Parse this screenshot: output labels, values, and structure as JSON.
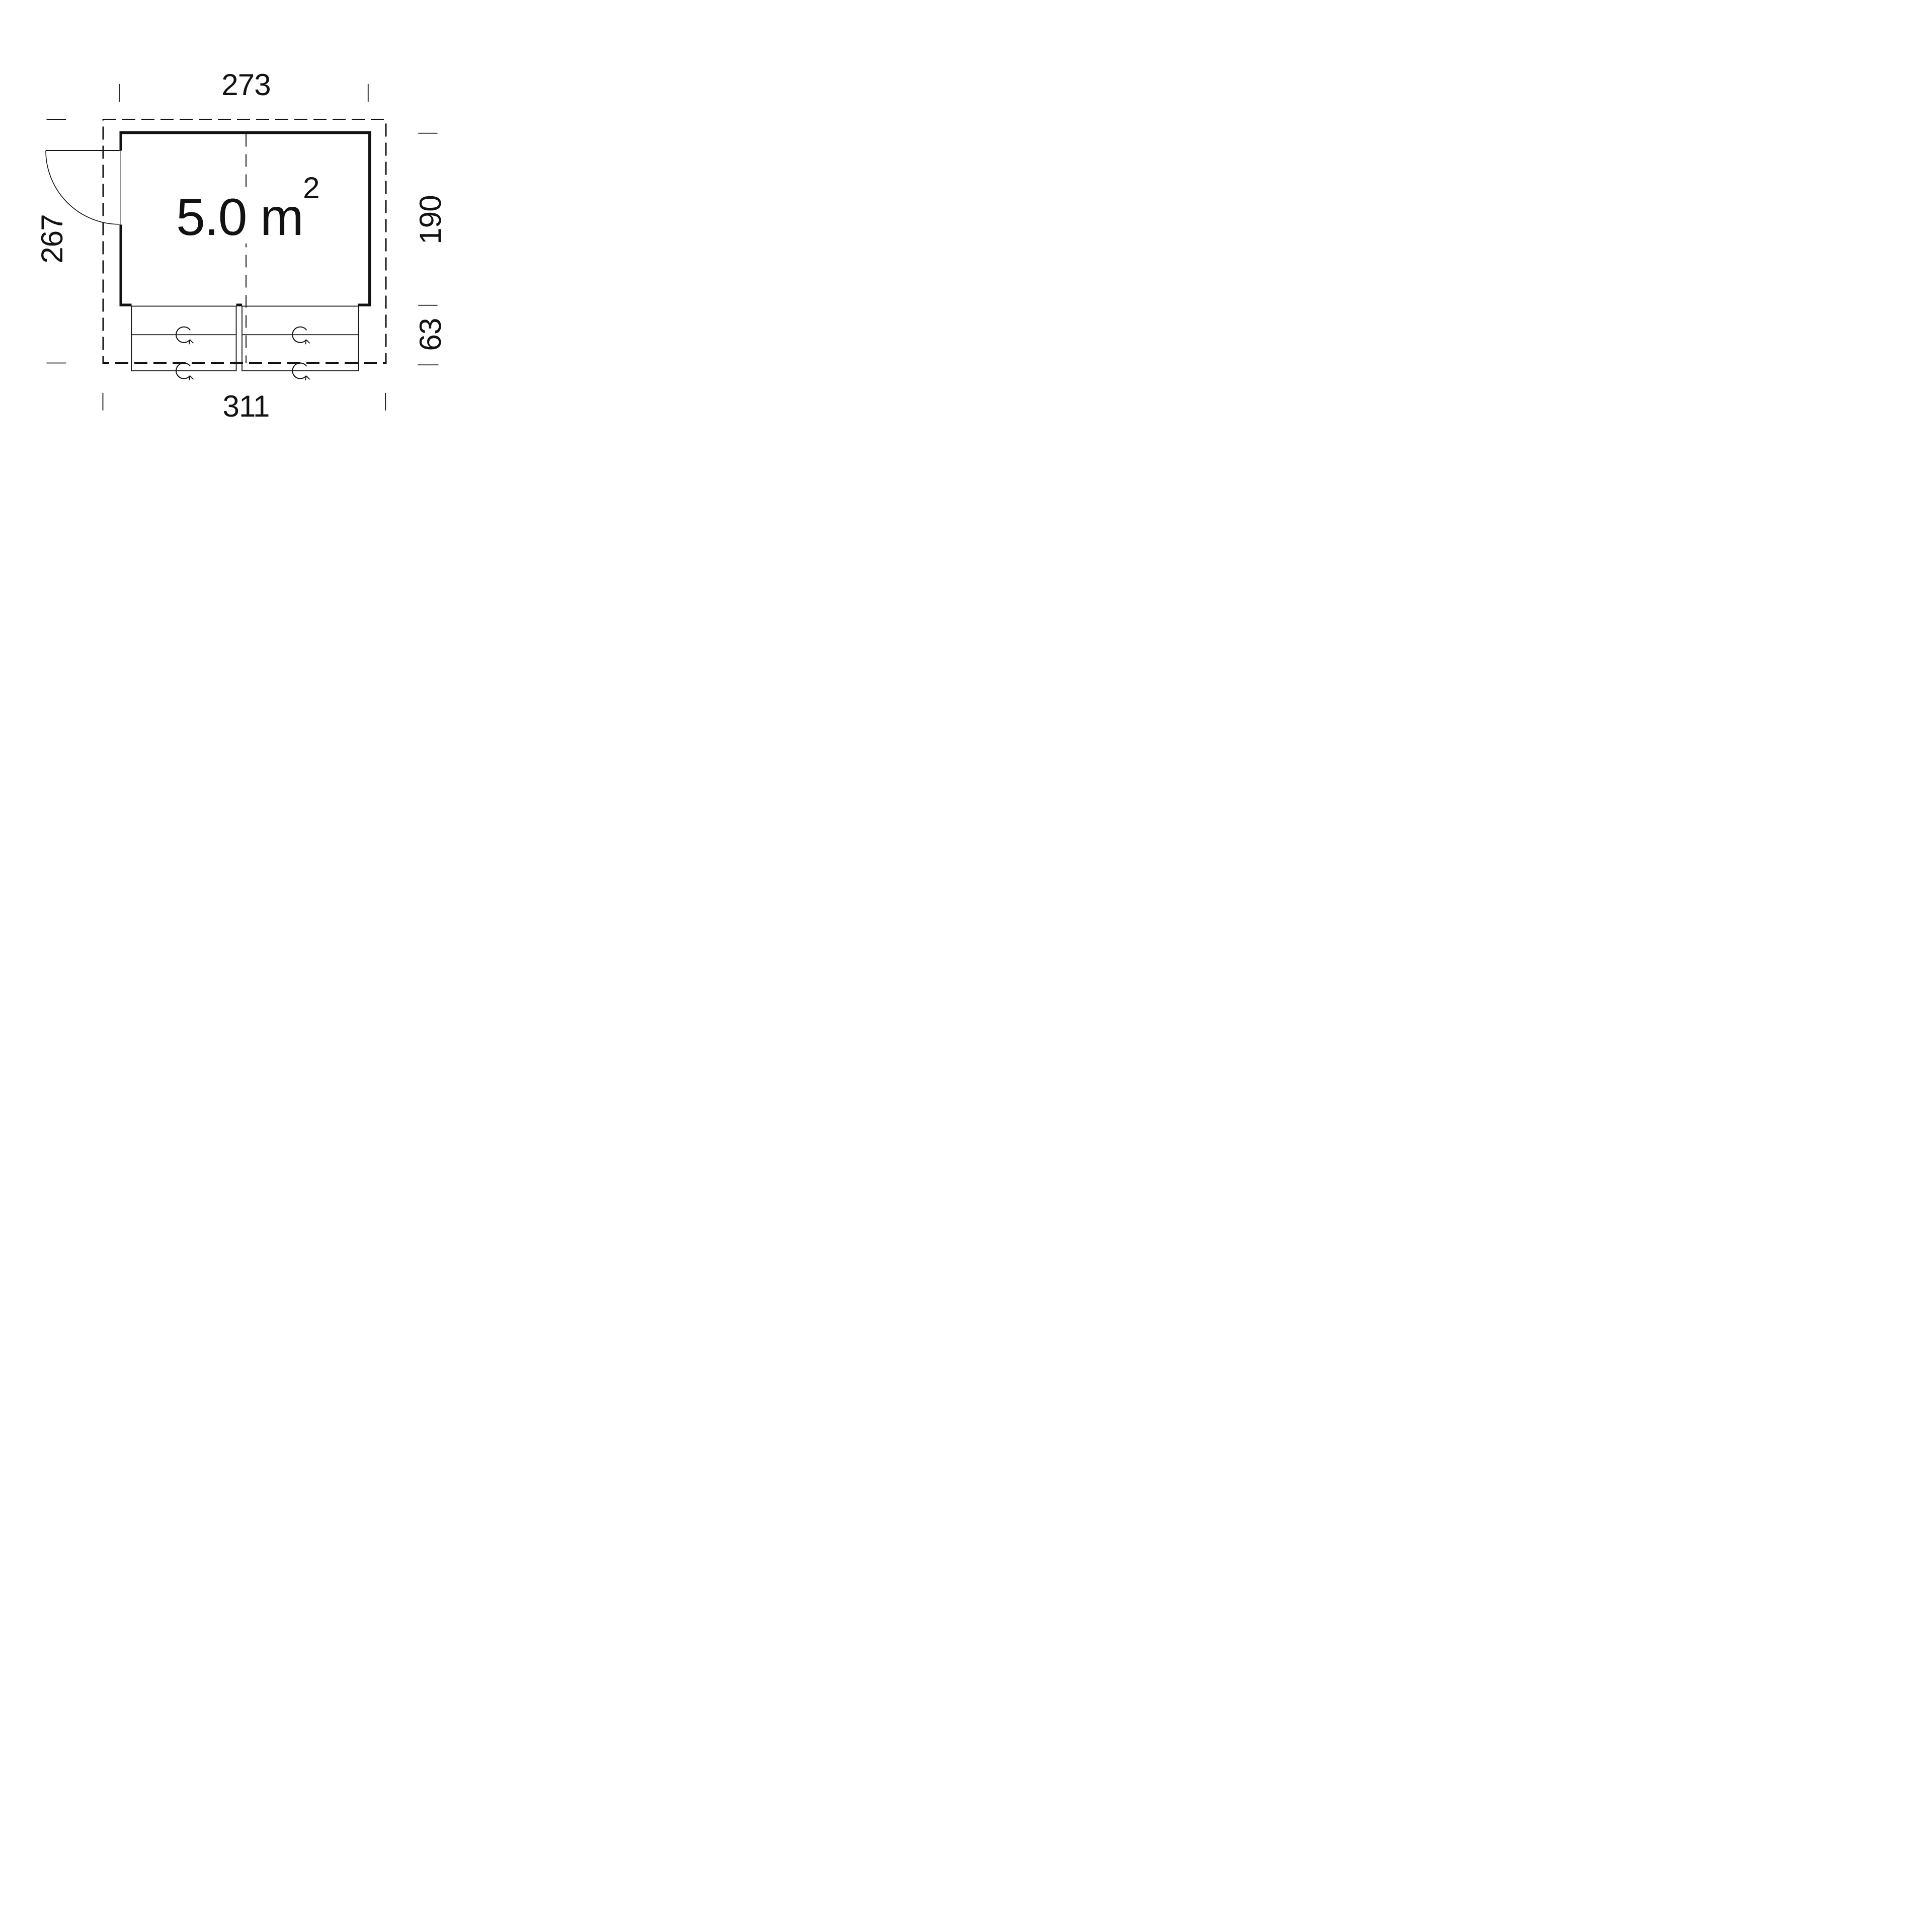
{
  "plan": {
    "type": "floor-plan",
    "area": {
      "value": "5.0",
      "unit": "m",
      "exponent": "2"
    },
    "dimensions": {
      "top_width": "273",
      "bottom_total_width": "311",
      "left_total_depth": "267",
      "right_room_depth": "190",
      "right_counter_depth": "63"
    },
    "features": {
      "door": "single door, left wall, opens outward",
      "counter_flaps": "two fold-out counter flaps on bottom wall",
      "rotation_symbol": "circular-arrow"
    },
    "colors": {
      "line": "#121212",
      "background": "#ffffff"
    }
  }
}
